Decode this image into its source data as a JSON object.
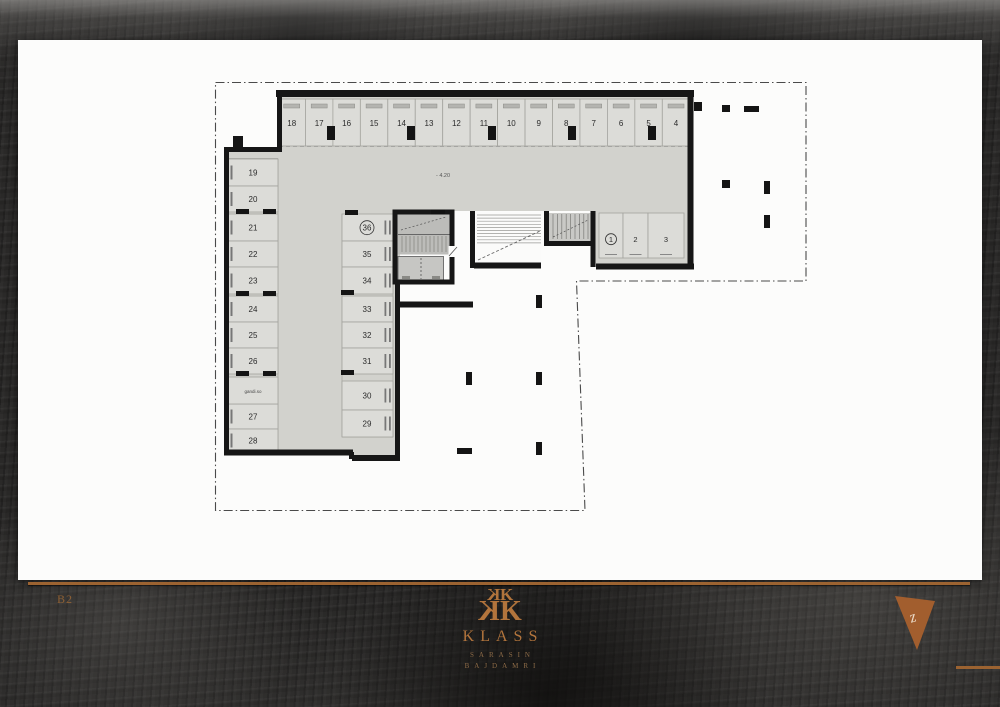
{
  "plan": {
    "elevation_label": "- 4.20",
    "strip_label": "gandi.so",
    "top_row_spaces": [
      "18",
      "17",
      "16",
      "15",
      "14",
      "13",
      "12",
      "11",
      "10",
      "9",
      "8",
      "7",
      "6",
      "5",
      "4"
    ],
    "left_col_spaces": [
      "19",
      "20",
      "21",
      "22",
      "23",
      "24",
      "25",
      "26",
      "27",
      "28"
    ],
    "mid_col_spaces": [
      "36",
      "35",
      "34",
      "33",
      "32",
      "31",
      "30",
      "29"
    ],
    "right_block_spaces": [
      "1",
      "2",
      "3"
    ],
    "circled_spaces": [
      "36",
      "1"
    ]
  },
  "footer": {
    "level_label": "B2",
    "brand": "KLASS",
    "brand_sub1": "SARASIN",
    "brand_sub2": "BAJDAMRI",
    "monogram_letter": "K",
    "north_letter": "z"
  },
  "colors": {
    "copper": "#b2743c",
    "wall": "#161616",
    "aisle_gray": "#d2d2cd",
    "stall_gray": "#dcdcd8"
  }
}
